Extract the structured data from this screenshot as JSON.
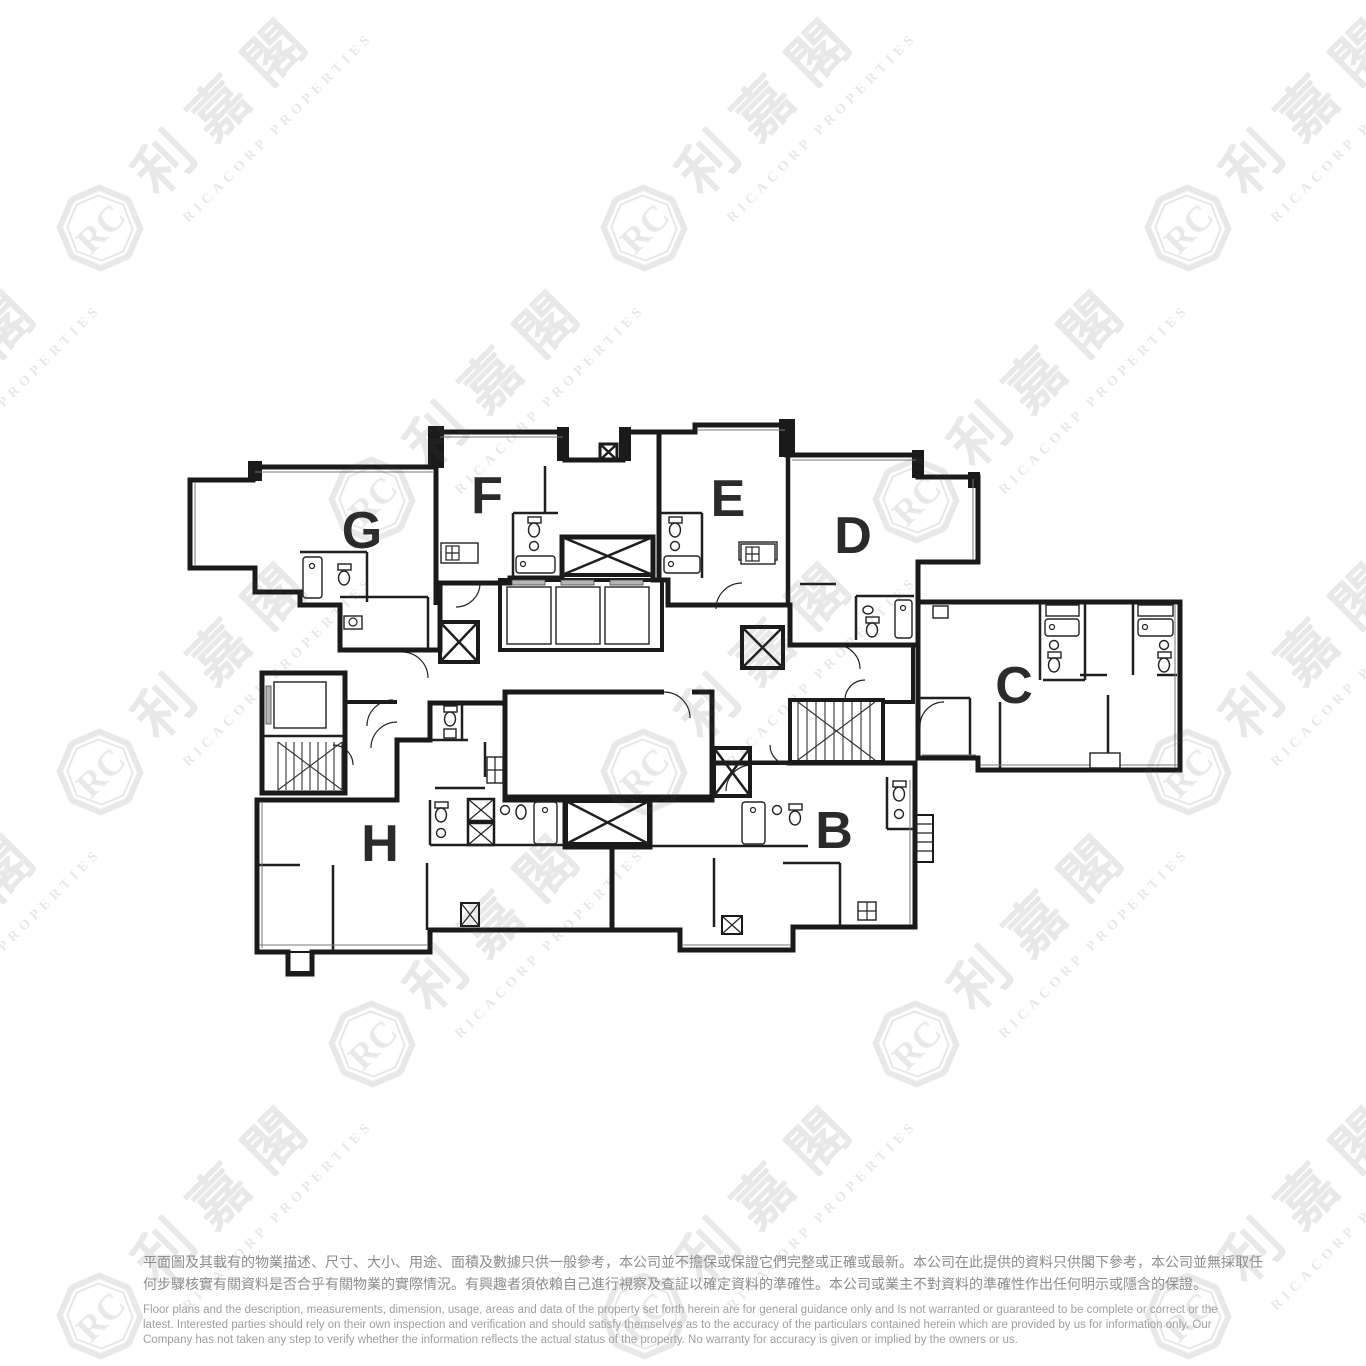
{
  "plan": {
    "units": {
      "g": "G",
      "f": "F",
      "e": "E",
      "d": "D",
      "c": "C",
      "h": "H",
      "b": "B"
    },
    "colors": {
      "purple": "#c6c2df",
      "peach": "#fae6c9",
      "salmon": "#f8cabb",
      "wall": "#1a1a1a",
      "letter": "#2b2b2b"
    }
  },
  "watermark": {
    "cjk": "利嘉閣",
    "en": "RICACORP PROPERTIES",
    "monogram": "RC"
  },
  "disclaimer": {
    "zh": [
      "平面圖及其載有的物業描述、尺寸、大小、用途、面積及數據只供一般參考，本公司並不擔保或保證它們完整或正確或最新。本公司在此提供的資料只供閣下參考，本公司並無採取任",
      "何步驟核實有關資料是否合乎有關物業的實際情況。有興趣者須依賴自己進行視察及查証以確定資料的準確性。本公司或業主不對資料的準確性作出任何明示或隱含的保證。"
    ],
    "en": [
      "Floor plans and the description, measurements, dimension, usage, areas and data of the property set forth herein are for general guidance only and Is not warranted or guaranteed to be complete or correct or the",
      "latest. Interested parties should rely on their own inspection and verification and should satisfy themselves as to the accuracy of the particulars contained herein which are provided by us for information only.  Our",
      "Company has not taken any step to verify whether the information reflects the actual status of the property.  No warranty for accuracy is given or implied by the owners or us."
    ]
  }
}
